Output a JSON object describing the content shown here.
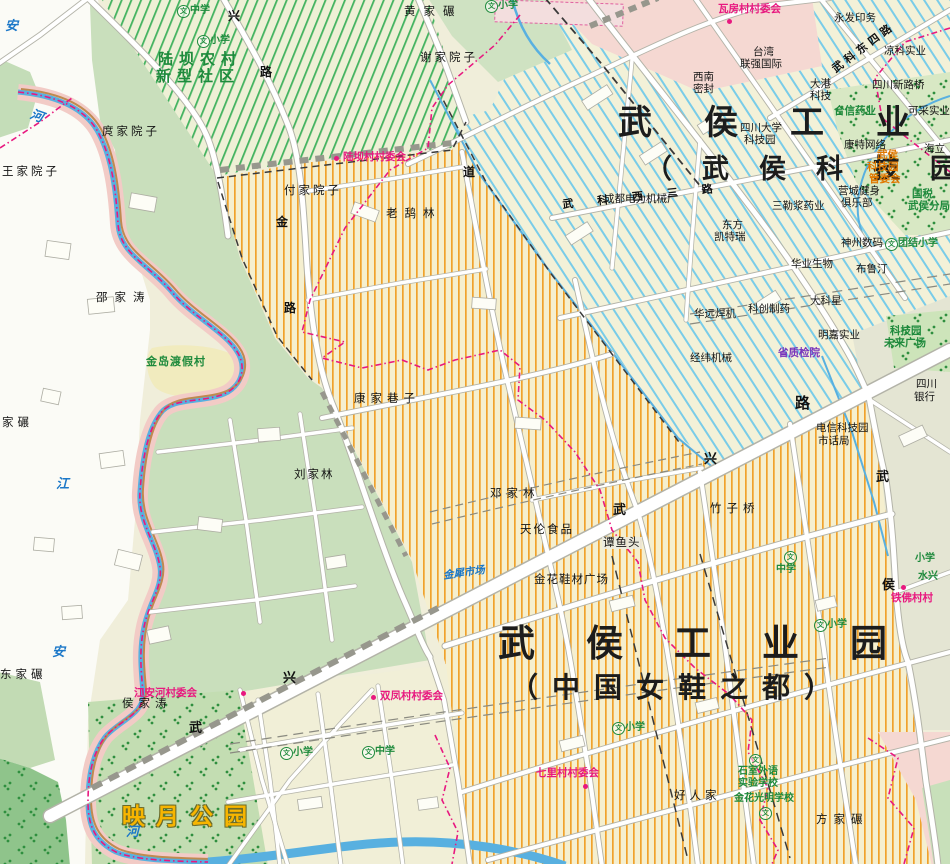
{
  "big_titles": {
    "tech_line1": "武侯工业",
    "tech_line2": "（武侯科技园",
    "shoe_line1": "武侯工业园",
    "shoe_line2": "（中国女鞋之都）",
    "park": "映月公园",
    "community_line1": "陆坝农村",
    "community_line2": "新型社区"
  },
  "places": [
    "黄家碾",
    "谢家院子",
    "庹家院子",
    "王家院子",
    "付家院子",
    "老鸹林",
    "邵家涛",
    "康家巷子",
    "刘家林",
    "邓家林",
    "天伦食品",
    "谭鱼头",
    "金花鞋材广场",
    "竹子桥",
    "侯家涛",
    "好人家",
    "方家碾",
    "东家碾",
    "家碾",
    "金岛渡假村"
  ],
  "committees": [
    "瓦房村村委会",
    "陆坝村村委会",
    "江安河村委会",
    "双凤村村委会",
    "七里村村委会",
    "铁佛村村"
  ],
  "companies": [
    "永发印务",
    "凉科实业",
    "台湾",
    "联强国际",
    "西南",
    "密封",
    "大港",
    "科技",
    "四川新路桥",
    "合信药业",
    "可采实业",
    "四川大学",
    "科技园",
    "康特网络",
    "海立",
    "成都电力机械厂",
    "三勒浆药业",
    "营城健身",
    "俱乐部",
    "东方",
    "凯特瑞",
    "神州数码",
    "华业生物",
    "布鲁汀",
    "科创制药",
    "大科星",
    "华远焊机",
    "明嘉实业",
    "经纬机械",
    "省质检院",
    "科技园",
    "未来广场",
    "电信科技园",
    "市话局",
    "四川",
    "银行",
    "国税",
    "武侯分局",
    "金犀市场",
    "武侯",
    "科技园",
    "管委会"
  ],
  "schools": [
    "中学",
    "小学",
    "小学",
    "中学",
    "小学",
    "小学",
    "中学",
    "小学",
    "石室外语",
    "实验学校",
    "金花光明学校",
    "团结小学",
    "小学",
    "水兴"
  ],
  "river_labels": [
    "安",
    "河",
    "江",
    "安",
    "河"
  ],
  "road_labels": [
    "兴",
    "路",
    "金",
    "路",
    "武",
    "兴",
    "武",
    "兴",
    "路",
    "武",
    "侯",
    "道",
    "武科东四路",
    "武科西三路"
  ],
  "icons": {
    "school_char": "文"
  },
  "colors": {
    "orange_stripe": "#f0a22c",
    "blue_hatch": "#79cce8",
    "green_hatch": "#44b360",
    "river": "#58b0e0",
    "boundary": "#e8187f",
    "road_fill": "#ffffff",
    "park_green": "#c3ddb2",
    "zone_pink": "#f5d8d2",
    "title_black": "#1c1c1c",
    "school_green": "#1e8a3c",
    "committee_red": "#e8187f",
    "market_blue": "#1c78c8",
    "park_title_orange": "#f7b500",
    "mgmt_orange": "#e07800",
    "quality_purple": "#7733bb"
  }
}
